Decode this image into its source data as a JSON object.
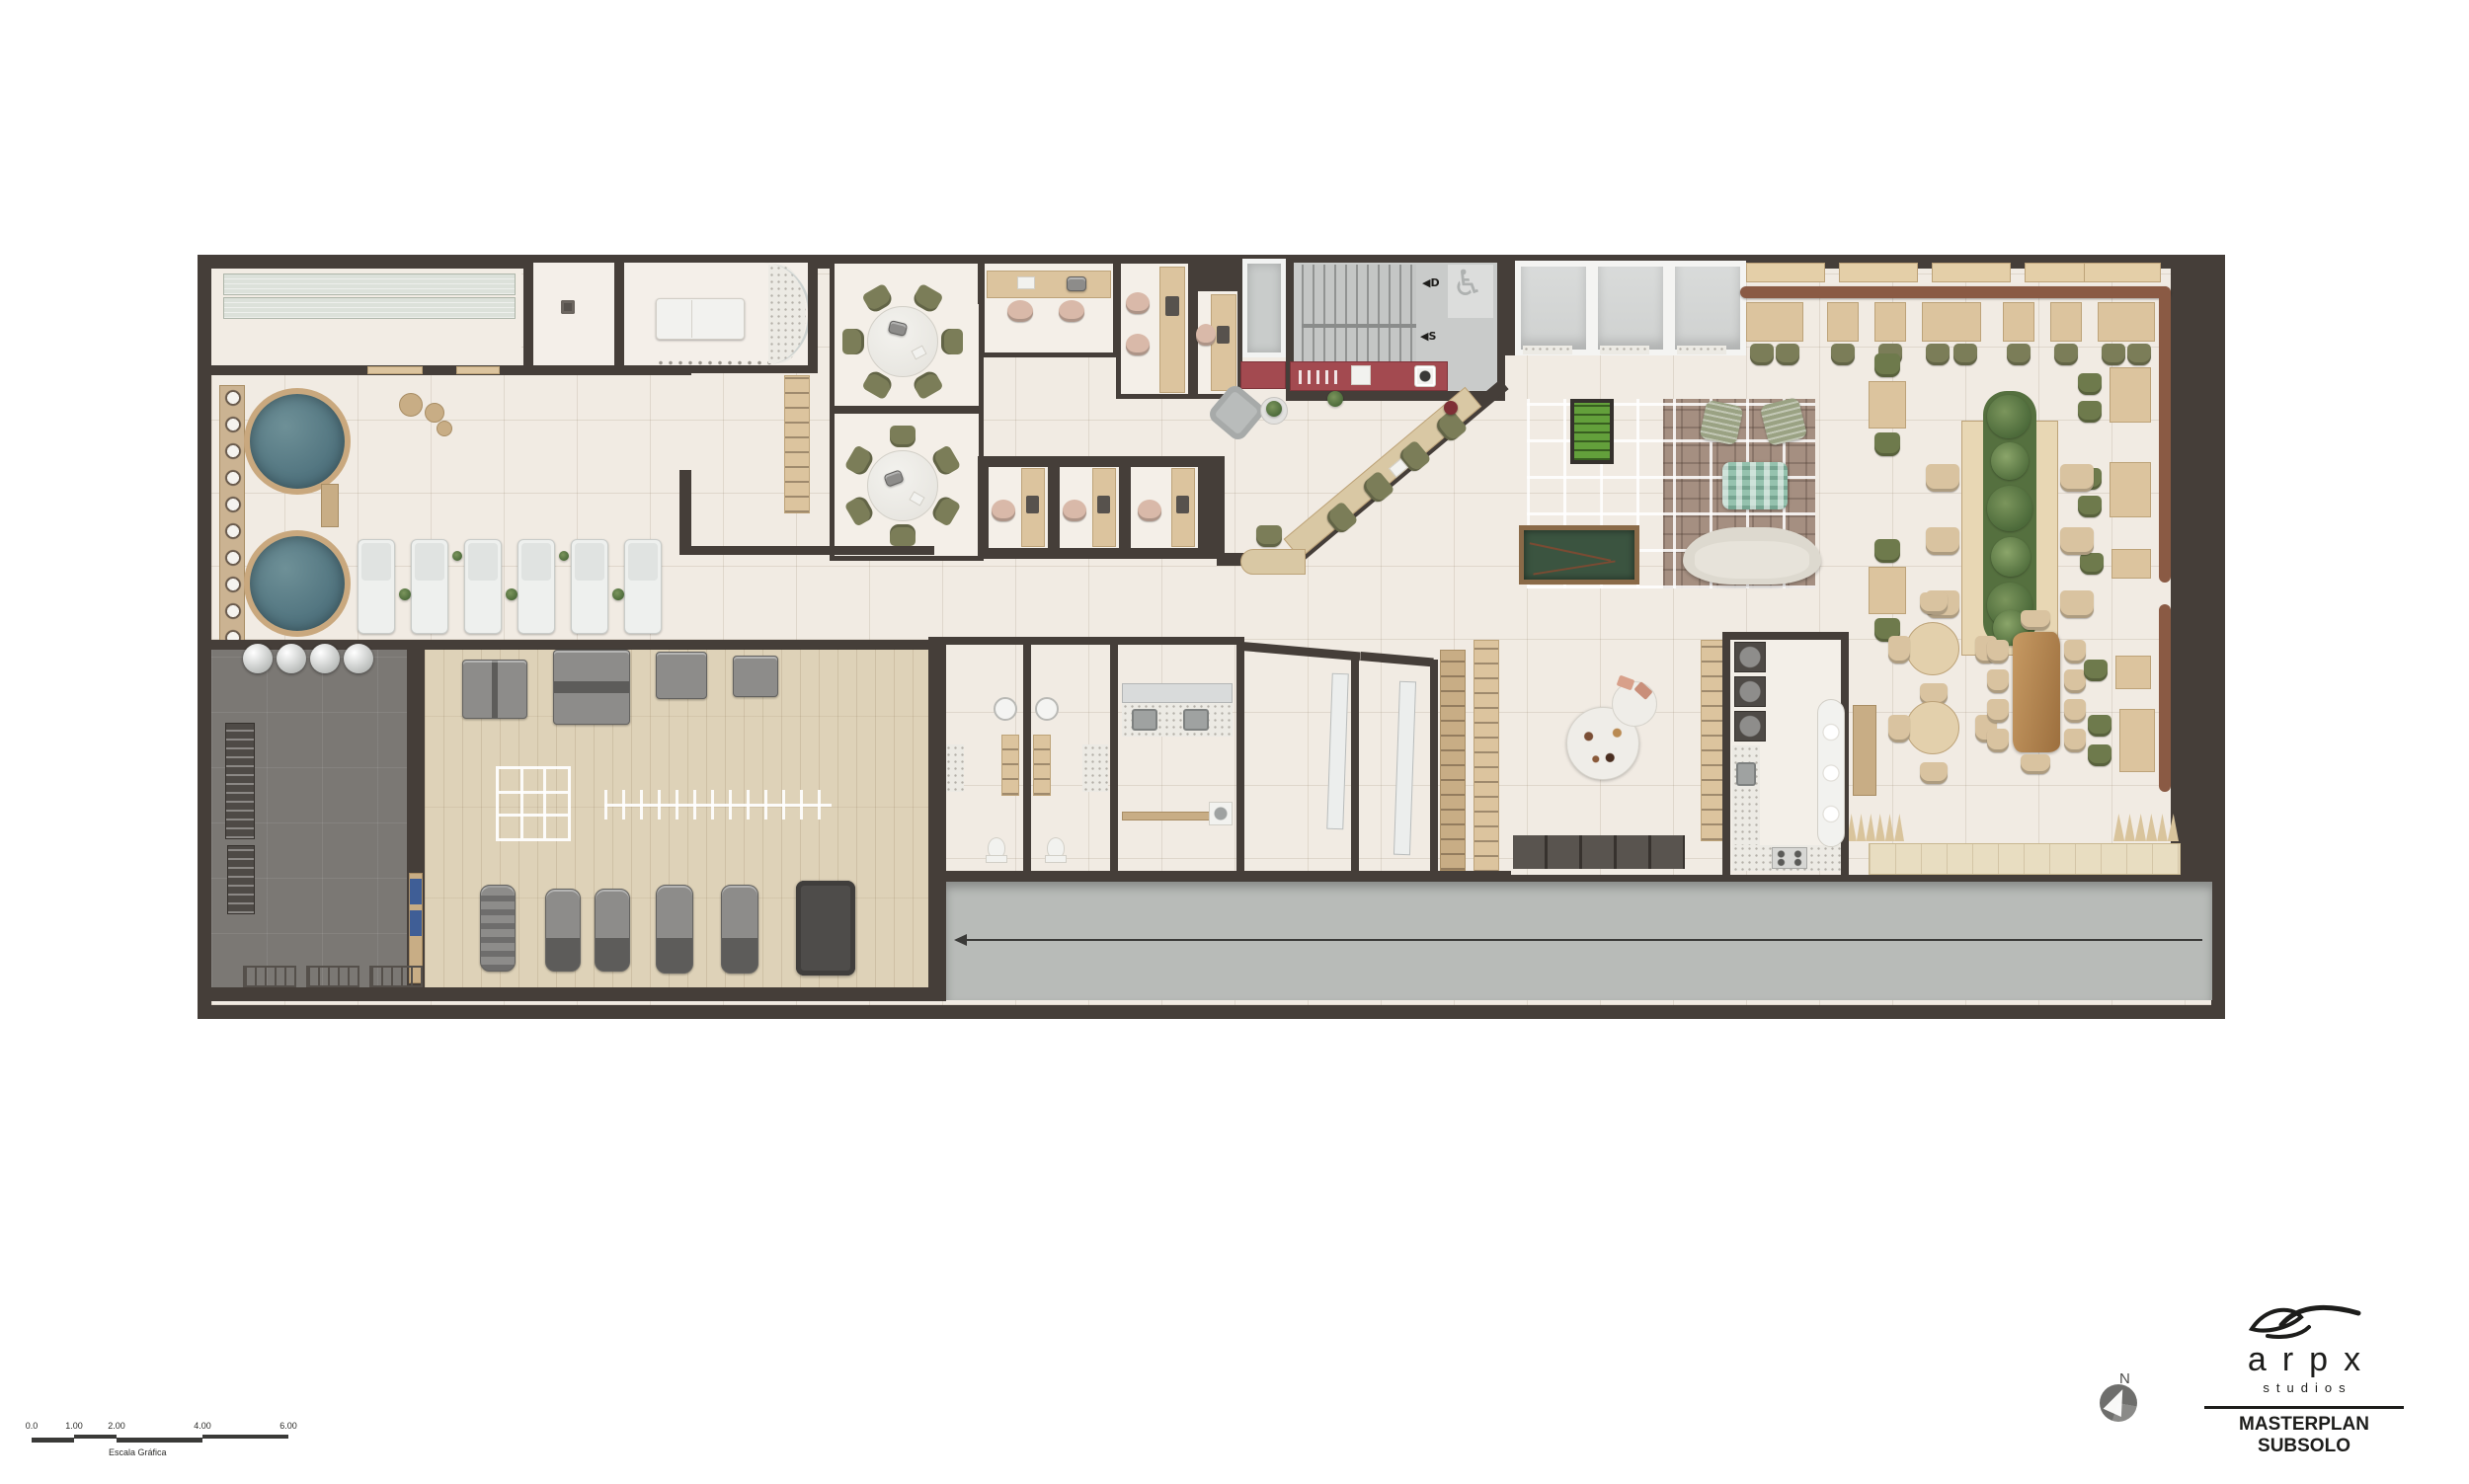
{
  "sheet": {
    "background": "#ffffff"
  },
  "plan": {
    "colors": {
      "wall": "#453e39",
      "floor": "#f1ebe3",
      "gym_dark_floor": "#7b7874",
      "gym_wood_floor": "#ded2b8",
      "corridor": "#b8bbb8",
      "pool_water": "#527580",
      "accent_red": "#a34a50",
      "banquette_brown": "#8a5a44",
      "chair_olive": "#7b7d58",
      "billiards_green": "#3c5742",
      "foosball_green": "#63a03b"
    }
  },
  "stairwell": {
    "down_label": "◀D",
    "up_label": "◀S",
    "accessibility_glyph": "♿"
  },
  "north_indicator": {
    "label": "N"
  },
  "scale_bar": {
    "caption": "Escala Gráfica",
    "labels": [
      "0.0",
      "1.00",
      "2.00",
      "4.00",
      "6.00"
    ]
  },
  "title_block": {
    "brand": "arpx",
    "sub_brand": "studios",
    "title": "MASTERPLAN SUBSOLO"
  }
}
